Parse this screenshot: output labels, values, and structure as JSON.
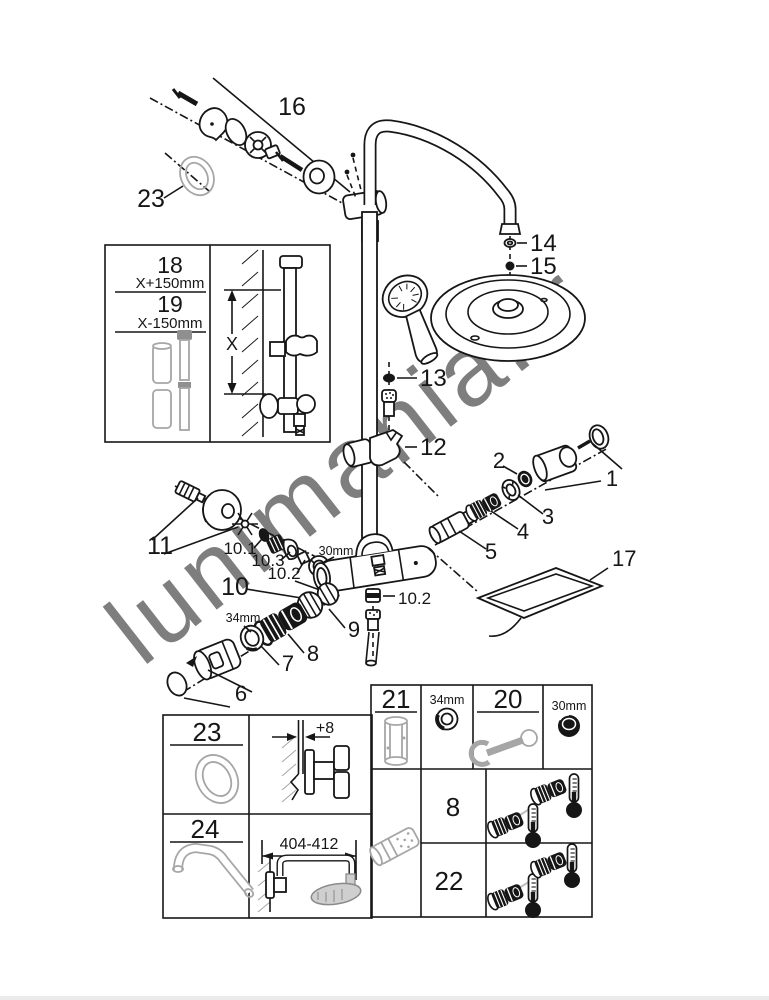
{
  "watermark": "lunimania.fr",
  "diagram": {
    "labels": {
      "n16": "16",
      "n23_top": "23",
      "n14": "14",
      "n15": "15",
      "n13": "13",
      "n12": "12",
      "n1": "1",
      "n2": "2",
      "n3": "3",
      "n4": "4",
      "n5": "5",
      "n17": "17",
      "n11": "11",
      "n10": "10",
      "n10_1": "10.1",
      "n10_3": "10.3",
      "n10_2": "10.2",
      "n10_2_right": "10.2",
      "n30mm": "30mm",
      "n34mm": "34mm",
      "n9": "9",
      "n8": "8",
      "n7": "7",
      "n6": "6"
    },
    "inset_rail_box": {
      "n18": "18",
      "dim18": "X+150mm",
      "n19": "19",
      "dim19": "X-150mm",
      "dim_x": "X"
    },
    "table_left": {
      "n23": "23",
      "dim_offset": "+8",
      "n24": "24",
      "dim_arm_length": "404-412"
    },
    "table_right": {
      "n21": "21",
      "dim34": "34mm",
      "n20": "20",
      "dim30": "30mm",
      "n8": "8",
      "n22": "22"
    }
  },
  "colors": {
    "line": "#161616",
    "gray_part": "#a6a6a6",
    "watermark_gray": "#bdbdbd",
    "bottom_bar": "#ebebeb"
  }
}
